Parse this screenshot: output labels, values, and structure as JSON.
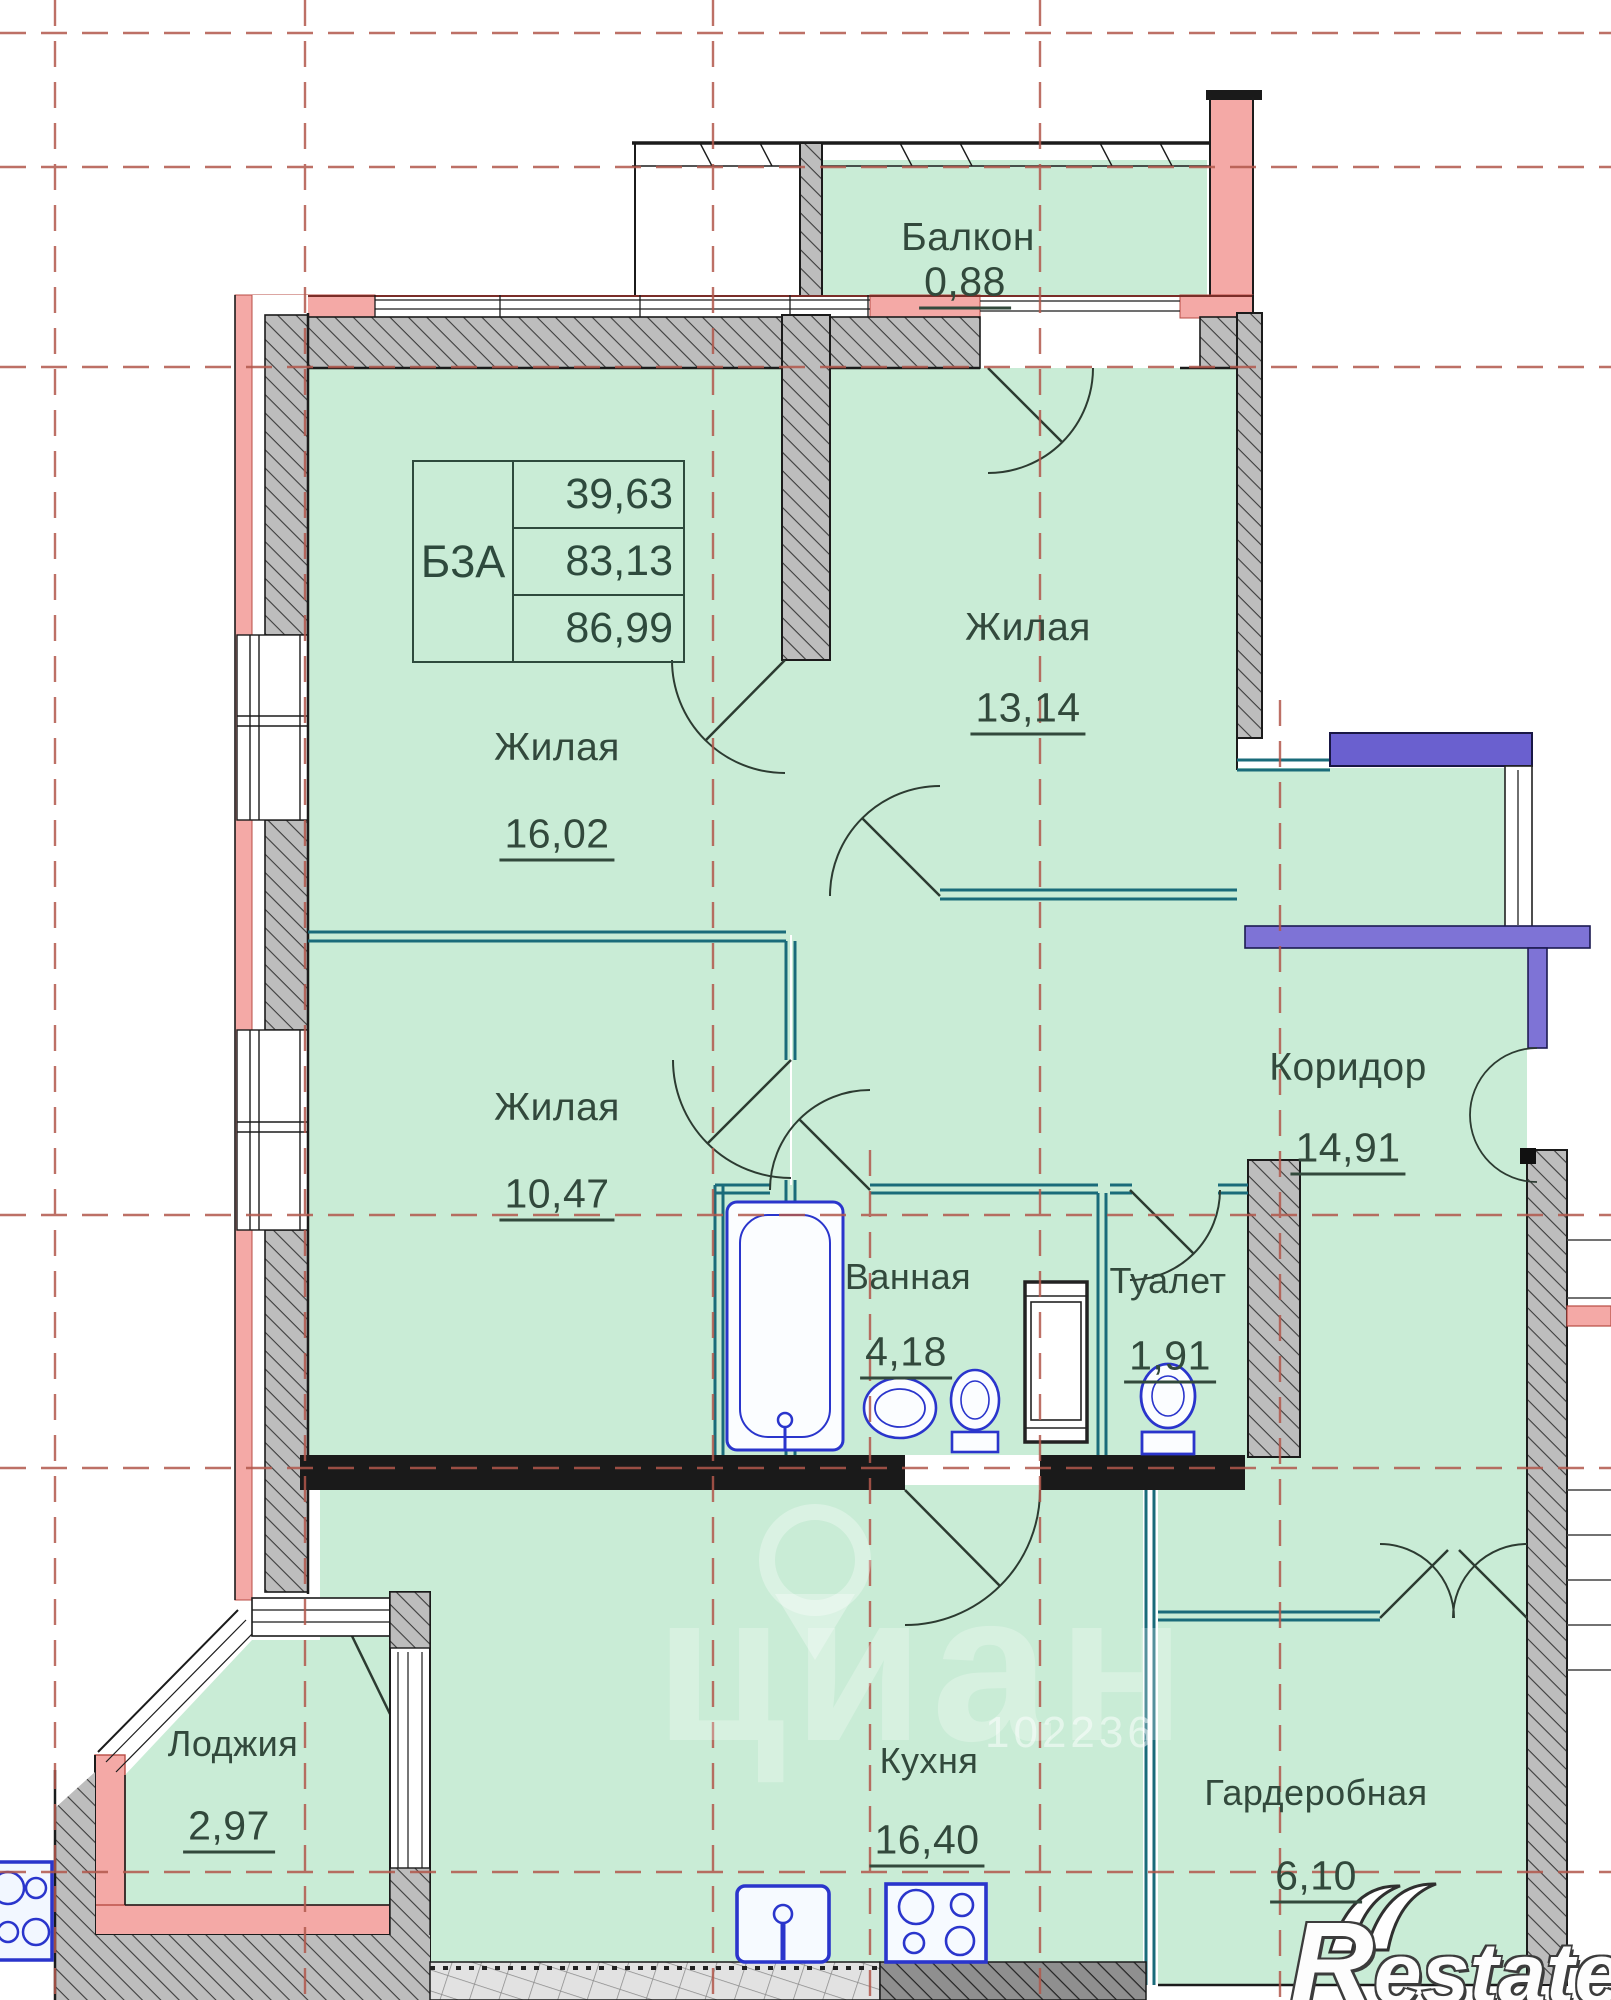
{
  "plan": {
    "unit": {
      "label": "Б3А",
      "values": [
        "39,63",
        "83,13",
        "86,99"
      ]
    },
    "rooms": [
      {
        "name": "Балкон",
        "area": "0,88"
      },
      {
        "name": "Жилая",
        "area": "13,14"
      },
      {
        "name": "Жилая",
        "area": "16,02"
      },
      {
        "name": "Жилая",
        "area": "10,47"
      },
      {
        "name": "Коридор",
        "area": "14,91"
      },
      {
        "name": "Ванная",
        "area": "4,18"
      },
      {
        "name": "Туалет",
        "area": "1,91"
      },
      {
        "name": "Лоджия",
        "area": "2,97"
      },
      {
        "name": "Кухня",
        "area": "16,40"
      },
      {
        "name": "Гардеробная",
        "area": "6,10"
      }
    ],
    "watermarks": {
      "cian": "циан",
      "listing_id": "102236",
      "brand_initial": "R",
      "brand_rest": "estate"
    },
    "colors": {
      "room_fill": "#c9ecd6",
      "exterior_insulation_pink": "#f4a9a6",
      "bearing_wall_gray": "#bdbdbd",
      "partition_teal": "#1a6b7a",
      "entrance_purple": "#7e73d6",
      "fixtures_blue": "#2a35cc",
      "axis_red": "#b2584c",
      "label_text": "#32493c"
    }
  }
}
